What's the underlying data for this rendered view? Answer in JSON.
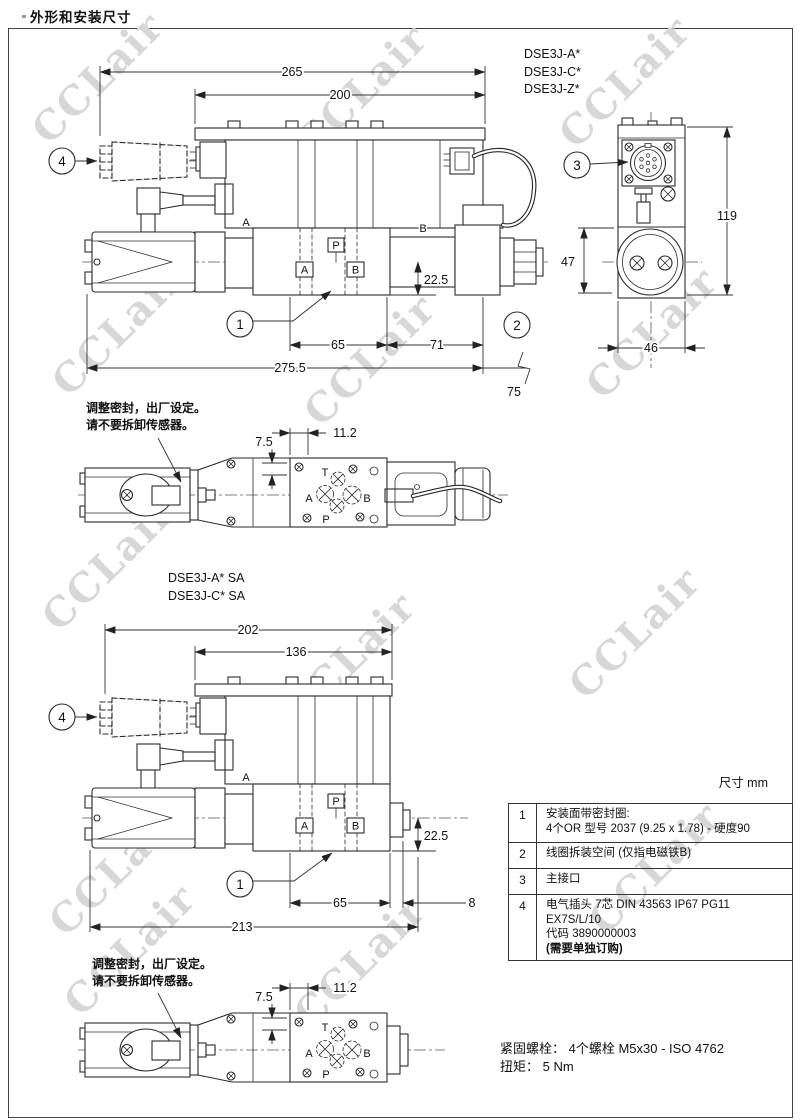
{
  "page": {
    "title": "外形和安装尺寸",
    "units_label": "尺寸 mm",
    "watermark_text": "CCLair",
    "fastening_line1": "紧固螺栓：  4个螺栓  M5x30 - ISO 4762",
    "fastening_line2": "扭矩：  5 Nm"
  },
  "callouts": {
    "c1": "1",
    "c2": "2",
    "c3": "3",
    "c4": "4"
  },
  "ports": {
    "a": "A",
    "b": "B",
    "p": "P",
    "t": "T"
  },
  "view1": {
    "models": [
      "DSE3J-A*",
      "DSE3J-C*",
      "DSE3J-Z*"
    ],
    "dim_overall": "265",
    "dim_body": "200",
    "dim_center_bottom": "22.5",
    "dim_ports": "65",
    "dim_solenoid": "71",
    "dim_total": "275.5",
    "dim_cable_clearance": "75"
  },
  "end_view": {
    "dim_height": "119",
    "dim_coil": "47",
    "dim_width": "46"
  },
  "top_view": {
    "dim_offset_v": "7.5",
    "dim_offset_h": "11.2",
    "note_line1": "调整密封，出厂设定。",
    "note_line2": "请不要拆卸传感器。"
  },
  "view2": {
    "models": [
      "DSE3J-A* SA",
      "DSE3J-C* SA"
    ],
    "dim_overall": "202",
    "dim_body": "136",
    "dim_center_bottom": "22.5",
    "dim_ports": "65",
    "dim_plug": "8",
    "dim_total": "213"
  },
  "top_view2": {
    "dim_offset_v": "7.5",
    "dim_offset_h": "11.2",
    "note_line1": "调整密封，出厂设定。",
    "note_line2": "请不要拆卸传感器。"
  },
  "notes_table": {
    "rows": [
      {
        "num": "1",
        "line1": "安装面带密封圈:",
        "line2": "4个OR 型号 2037 (9.25 x 1.78) - 硬度90"
      },
      {
        "num": "2",
        "line1": "线圈拆装空间 (仅指电磁铁B)"
      },
      {
        "num": "3",
        "line1": "主接口"
      },
      {
        "num": "4",
        "line1": "电气插头 7芯 DIN 43563 IP67 PG11",
        "line2": "EX7S/L/10",
        "line3": "代码 3890000003",
        "line4": "(需要单独订购)"
      }
    ]
  }
}
